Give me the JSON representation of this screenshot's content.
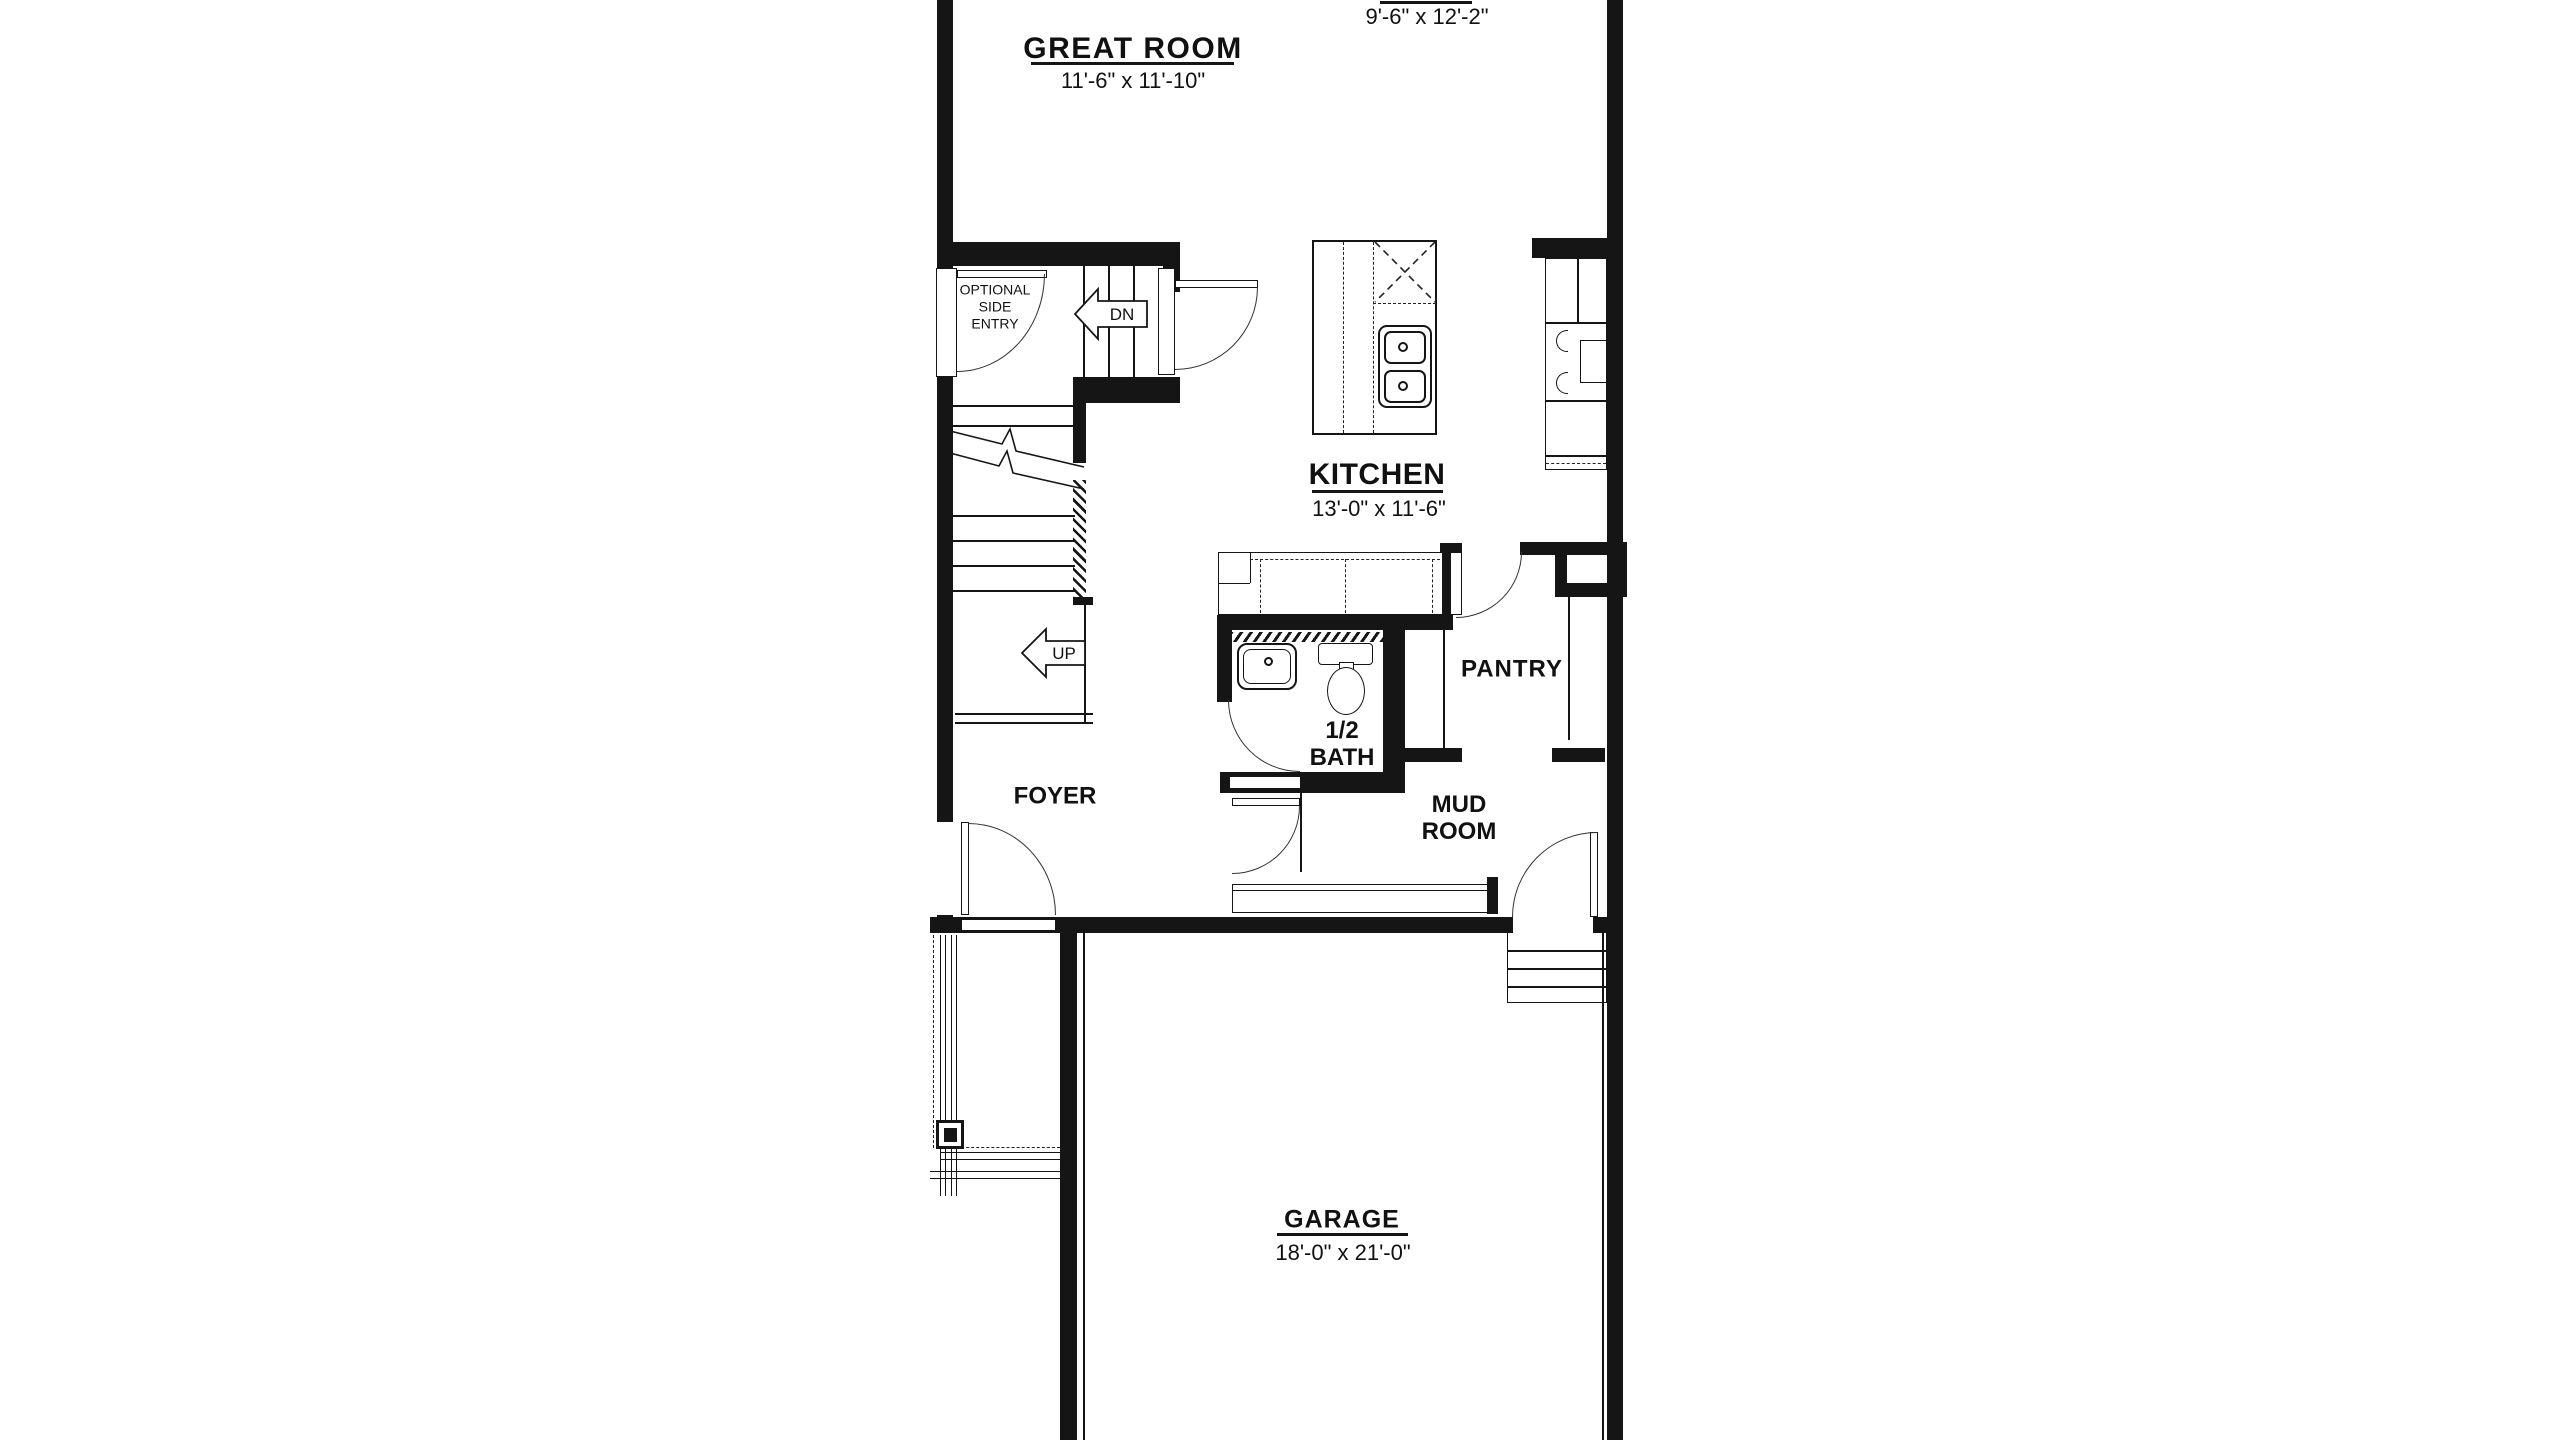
{
  "plan": {
    "type": "residential-floor-plan",
    "ink_color": "#151515",
    "background": "#ffffff",
    "rooms": {
      "great_room": {
        "title": "GREAT ROOM",
        "dims": "11'-6\" x 11'-10\""
      },
      "dining_nook": {
        "dims": "9'-6\" x 12'-2\""
      },
      "kitchen": {
        "title": "KITCHEN",
        "dims": "13'-0\" x 11'-6\""
      },
      "pantry": {
        "label": "PANTRY"
      },
      "half_bath": {
        "line1": "1/2",
        "line2": "BATH"
      },
      "foyer": {
        "label": "FOYER"
      },
      "mud_room": {
        "line1": "MUD",
        "line2": "ROOM"
      },
      "garage": {
        "title": "GARAGE",
        "dims": "18'-0\" x 21'-0\""
      },
      "side_entry": {
        "line1": "OPTIONAL",
        "line2": "SIDE",
        "line3": "ENTRY"
      }
    },
    "stairs": {
      "up": "UP",
      "dn": "DN"
    }
  }
}
